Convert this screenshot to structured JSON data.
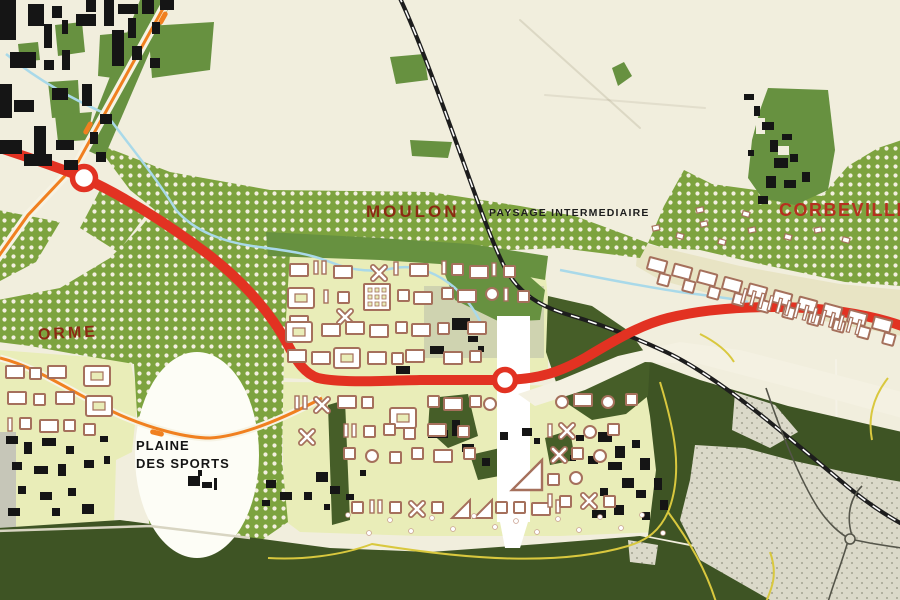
{
  "map": {
    "region_labels": {
      "moulon": "MOULON",
      "paysage_intermediaire": "PAYSAGE INTERMEDIAIRE",
      "corbeville": "CORBEVILLE",
      "orme": "ORME",
      "plaine_des_sports": {
        "line1": "PLAINE",
        "line2": "DES SPORTS"
      }
    },
    "palette": {
      "paper_cream": "#f1eedd",
      "dotted_field_green": "#7da33f",
      "solid_green": "#679140",
      "dark_forest_green": "#3e5424",
      "campus_pale_yellow": "#e9edb8",
      "strip_pale": "#e8e4c4",
      "town_gray": "#dbd9c9",
      "road_red": "#e23222",
      "road_orange": "#f08020",
      "road_yellow": "#d9c83e",
      "road_white": "#ffffff",
      "railway_black": "#1d1d1d",
      "stream_blue": "#a9d9e9",
      "building_black": "#151515",
      "building_outline_brown": "#a5705c",
      "label_dark_red": "#8b2a12",
      "label_red": "#b5301f",
      "label_black": "#1d1d1d"
    }
  }
}
